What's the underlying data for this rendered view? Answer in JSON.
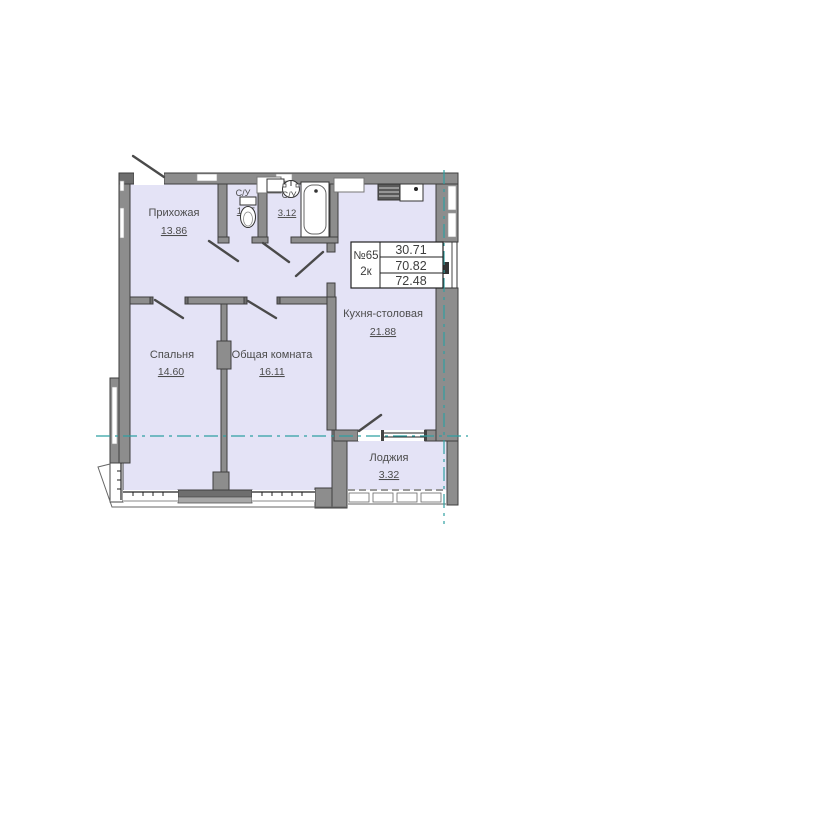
{
  "floor_plan": {
    "unit_info": {
      "number": "№65",
      "rooms_type": "2к",
      "living_area": "30.71",
      "floor_area": "70.82",
      "total_area": "72.48"
    },
    "rooms": [
      {
        "name": "Прихожая",
        "area": "13.86"
      },
      {
        "name": "С/У",
        "area": "1.25"
      },
      {
        "name": "С/У",
        "area": "3.12"
      },
      {
        "name": "Кухня-столовая",
        "area": "21.88"
      },
      {
        "name": "Спальня",
        "area": "14.60"
      },
      {
        "name": "Общая комната",
        "area": "16.11"
      },
      {
        "name": "Лоджия",
        "area": "3.32"
      }
    ],
    "colors": {
      "floor": "#e4e3f6",
      "wall": "#8d8d8d",
      "axis_line": "#2fa0a2",
      "highlight_red": "#ef2b24"
    }
  }
}
